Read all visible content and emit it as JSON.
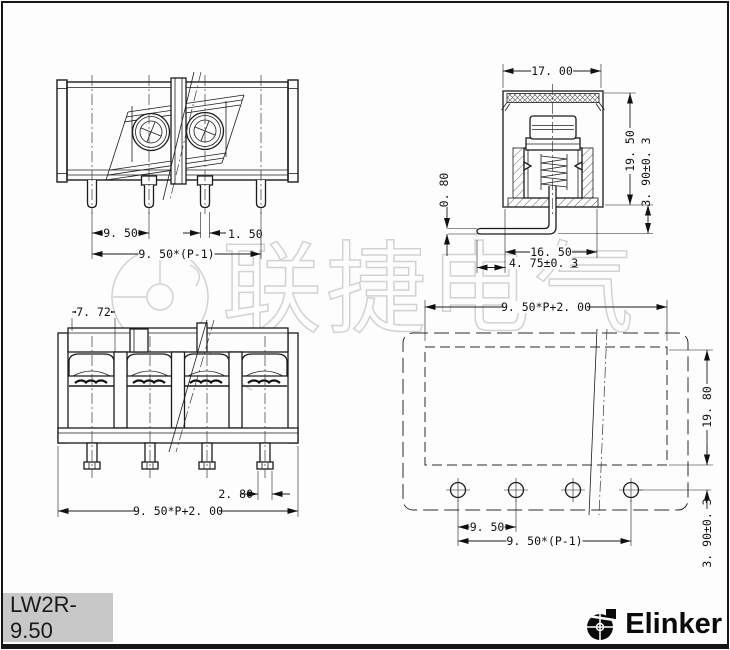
{
  "watermark": {
    "text": "联捷电气",
    "color": "#d2d2d2"
  },
  "title_block": {
    "part_number": "LW2R-9.50",
    "background": "#c8c8c8"
  },
  "brand": {
    "name": "Elinker"
  },
  "drawing": {
    "front_view": {
      "dims": {
        "pin_pitch": "9. 50",
        "pin_width": "1. 50",
        "pitch_span": "9. 50*(P-1)"
      }
    },
    "section_view": {
      "dims": {
        "top_width": "17. 00",
        "body_height": "19. 50",
        "lead_below": "3. 90±0. 3",
        "lead_thickness": "0. 80",
        "bottom_width": "16. 50",
        "lead_inset": "4. 75±0. 3"
      }
    },
    "rear_view": {
      "dims": {
        "unit_width": "7. 72",
        "pin_foot_width": "2. 80",
        "overall_length": "9. 50*P+2. 00"
      }
    },
    "pcb_view": {
      "dims": {
        "overall_length": "9. 50*P+2. 00",
        "outline_height": "19. 80",
        "hole_offset": "3. 90±0. 3",
        "hole_pitch": "9. 50",
        "hole_span": "9. 50*(P-1)"
      }
    }
  }
}
